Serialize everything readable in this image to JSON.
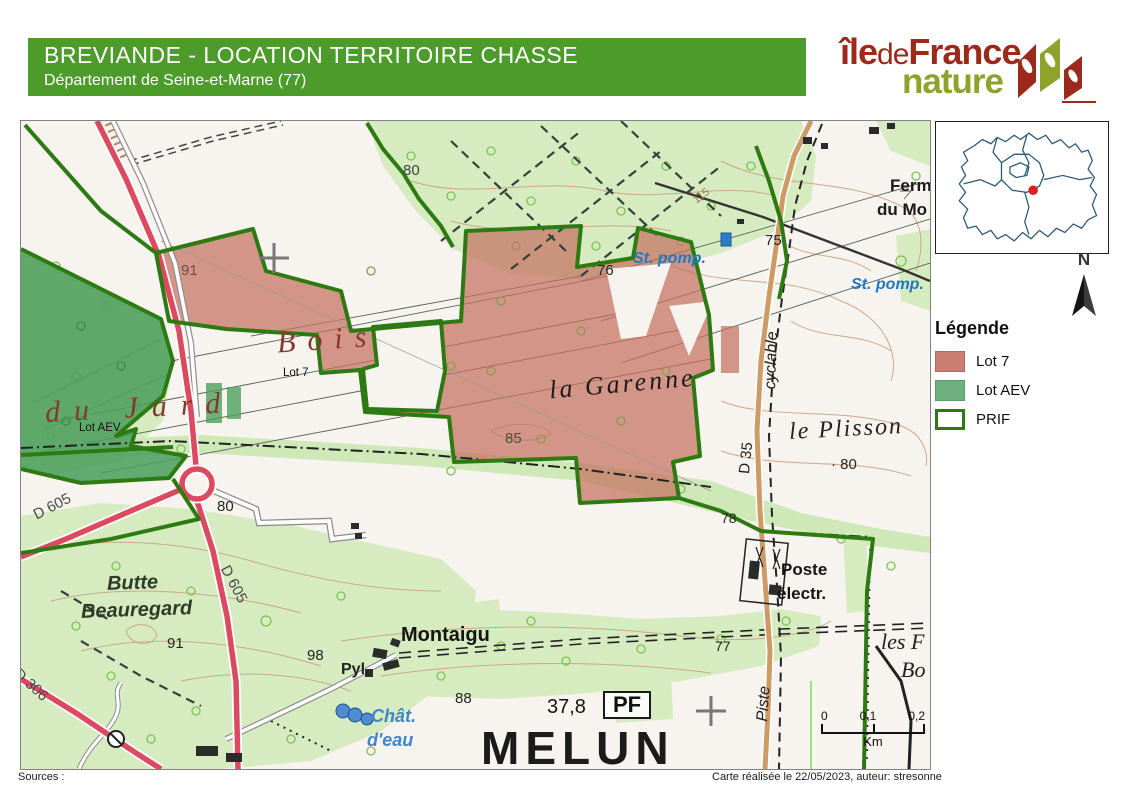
{
  "header": {
    "title": "BREVIANDE - LOCATION TERRITOIRE CHASSE",
    "subtitle": "Département de Seine-et-Marne (77)"
  },
  "logo": {
    "ile": "île",
    "de": "de",
    "france": "France",
    "nature": "nature"
  },
  "legend": {
    "title": "Légende",
    "items": [
      {
        "label": "Lot 7",
        "color": "#CB7E73"
      },
      {
        "label": "Lot AEV",
        "color": "#6EB07F"
      },
      {
        "label": "PRIF",
        "color": "#FFFFFF",
        "border": "#2E7A12"
      }
    ]
  },
  "north_label": "N",
  "scalebar": {
    "t0": "0",
    "t1": "0,1",
    "t2": "0,2",
    "unit": "Km"
  },
  "footer": {
    "sources": "Sources :",
    "credit": "Carte réalisée le 22/05/2023, auteur: stresonne"
  },
  "colors": {
    "header_green": "#4C9B2B",
    "logo_red": "#9B2A1D",
    "logo_olive": "#8FA32C",
    "lot7": "#C5705F",
    "lot_aev": "#4D9F5D",
    "prif": "#2E7A12",
    "red_road": "#DB4A5F",
    "tan_road": "#CE9B67",
    "hydro_blue": "#2277C4",
    "inset_outline": "#2B5876",
    "inset_dot": "#E21D1D"
  },
  "map_labels": [
    {
      "text": "80"
    },
    {
      "text": "115"
    },
    {
      "text": "Ferm"
    },
    {
      "text": "du Mo"
    },
    {
      "text": "75"
    },
    {
      "text": "St. pomp."
    },
    {
      "text": "St. pomp."
    },
    {
      "text": "76"
    },
    {
      "text": "91"
    },
    {
      "text": "Bois"
    },
    {
      "text": "du Jard"
    },
    {
      "text": "Lot 7"
    },
    {
      "text": "la Garenne"
    },
    {
      "text": "Lot AEV"
    },
    {
      "text": "85"
    },
    {
      "text": "le Plisson"
    },
    {
      "text": "· 80"
    },
    {
      "text": "D 35"
    },
    {
      "text": "cyclable"
    },
    {
      "text": "Piste"
    },
    {
      "text": "78"
    },
    {
      "text": "80"
    },
    {
      "text": "D 605"
    },
    {
      "text": "D 605"
    },
    {
      "text": "D 306"
    },
    {
      "text": "Butte"
    },
    {
      "text": "Beauregard"
    },
    {
      "text": "91"
    },
    {
      "text": "98"
    },
    {
      "text": "Pyl."
    },
    {
      "text": "Montaigu"
    },
    {
      "text": "88"
    },
    {
      "text": "Chât."
    },
    {
      "text": "d'eau"
    },
    {
      "text": "37,8"
    },
    {
      "text": "PF"
    },
    {
      "text": "MELUN"
    },
    {
      "text": "Poste"
    },
    {
      "text": "électr."
    },
    {
      "text": "77"
    },
    {
      "text": "les F"
    },
    {
      "text": "Bo"
    }
  ]
}
